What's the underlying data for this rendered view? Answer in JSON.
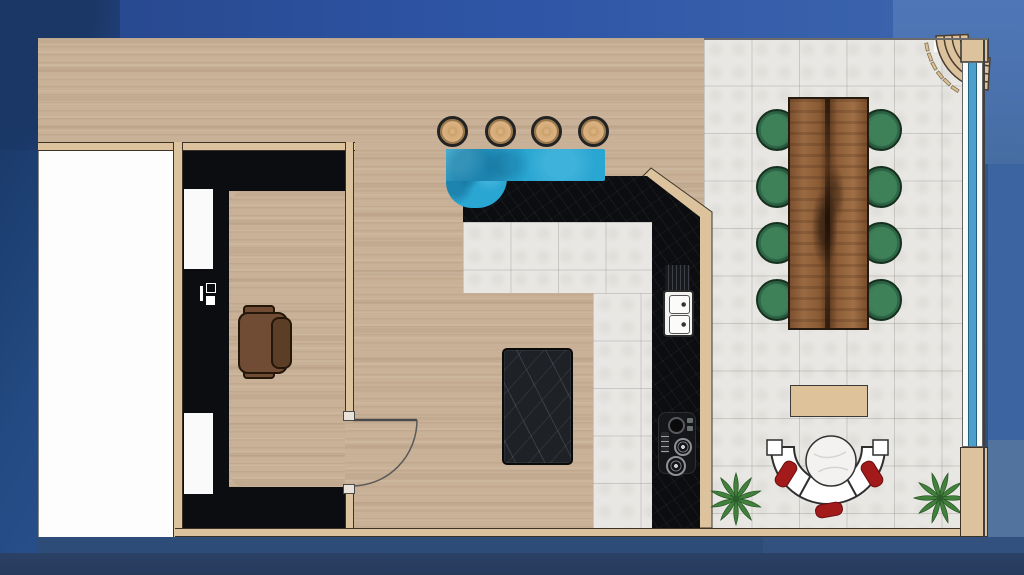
{
  "scene": {
    "kind": "interior-floor-plan-render",
    "view": "top-down architectural plan placed on a blue gradient backdrop",
    "visible_text": "none"
  },
  "colors": {
    "wood": "#c9b197",
    "tile": "#e9e7e3",
    "tan": "#dcc39e",
    "counter": "#0c0d10",
    "bar": "#2aa6d2",
    "chair": "#3e8058",
    "red": "#a31a1a",
    "plant": "#41813c",
    "window": "#4d9fcc",
    "bg-navy": "#16335f",
    "bg-blue": "#3a62a4"
  },
  "rooms": [
    {
      "name": "white-room",
      "floor": "white",
      "position": "far left"
    },
    {
      "name": "office",
      "floor": "wood with black wrap-around unit",
      "position": "left"
    },
    {
      "name": "kitchen",
      "floor": "white tile inside L-shaped black counter",
      "position": "center"
    },
    {
      "name": "dining-lounge",
      "floor": "large gray tiles",
      "position": "right"
    }
  ],
  "furniture": {
    "bar_stools": 4,
    "bar_counter": "blue irregular counter",
    "kitchen_island": "black marble slab",
    "sink": "double basin on right counter run",
    "cooktop": "black hob with round burners",
    "dining_table": "live-edge walnut slab",
    "dining_chairs": 8,
    "office_chair": 1,
    "console": "tan rectangle near sofa",
    "sofa": "semicircular white sectional",
    "sofa_cushions_red": 3,
    "coffee_table": "round marble",
    "plants": 2,
    "curved_staircase": "top-right corner",
    "doors": 1,
    "window_wall": "blue glazing strip on right side"
  }
}
